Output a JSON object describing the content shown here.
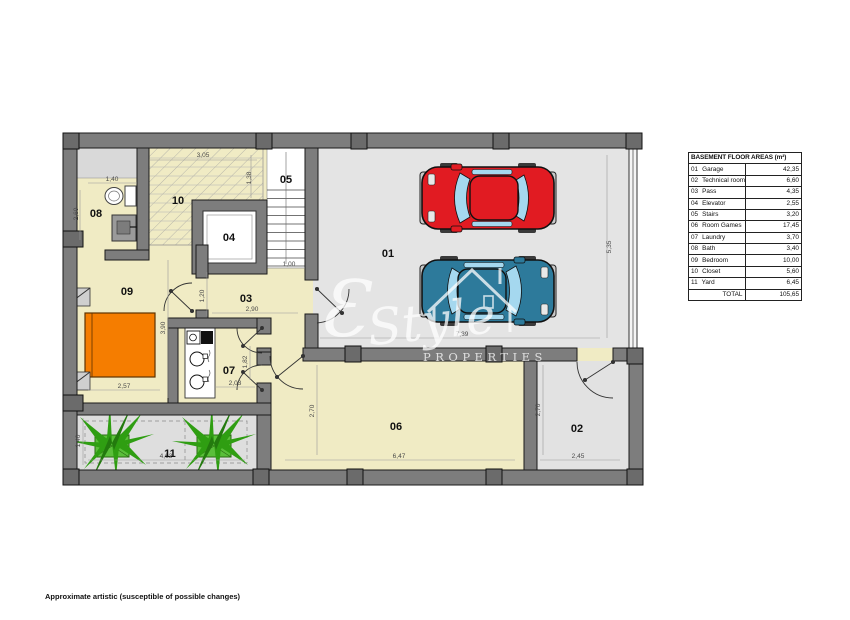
{
  "legend": {
    "title": "BASEMENT FLOOR AREAS (m²)",
    "rows": [
      {
        "no": "01",
        "name": "Garage",
        "area": "42,35"
      },
      {
        "no": "02",
        "name": "Technical room",
        "area": "6,60"
      },
      {
        "no": "03",
        "name": "Pass",
        "area": "4,35"
      },
      {
        "no": "04",
        "name": "Elevator",
        "area": "2,55"
      },
      {
        "no": "05",
        "name": "Stairs",
        "area": "3,20"
      },
      {
        "no": "06",
        "name": "Room Games",
        "area": "17,45"
      },
      {
        "no": "07",
        "name": "Laundry",
        "area": "3,70"
      },
      {
        "no": "08",
        "name": "Bath",
        "area": "3,40"
      },
      {
        "no": "09",
        "name": "Bedroom",
        "area": "10,00"
      },
      {
        "no": "10",
        "name": "Closet",
        "area": "5,60"
      },
      {
        "no": "11",
        "name": "Yard",
        "area": "6,45"
      }
    ],
    "total_label": "TOTAL",
    "total_value": "105,65"
  },
  "plan": {
    "room_labels": {
      "r01": "01",
      "r02": "02",
      "r03": "03",
      "r04": "04",
      "r05": "05",
      "r06": "06",
      "r07": "07",
      "r08": "08",
      "r09": "09",
      "r10": "10",
      "r11": "11"
    },
    "dims": {
      "closet_w": "3,05",
      "closet_h": "1,38",
      "bath_w": "1,40",
      "bath_h": "2,60",
      "stairs_w": "1,00",
      "garage_h": "5,35",
      "garage_w": "7,89",
      "bed_h": "3,90",
      "pass_d": "1,20",
      "pass_w": "2,90",
      "bed_w": "2,57",
      "laundry_w": "2,03",
      "laundry_h": "1,82",
      "yard_h": "1,40",
      "yard_w": "4,63",
      "games_h": "2,70",
      "games_w": "6,47",
      "tech_h": "2,70",
      "tech_w": "2,45"
    },
    "watermark": {
      "initial": "Ɛ",
      "script": "Style",
      "caption": "PROPERTIES"
    }
  },
  "footer": {
    "disclaimer": "Approximate artistic (susceptible of possible changes)"
  },
  "colors": {
    "cream": "#f0ebc4",
    "garage_floor": "#e4e4e4",
    "yard_floor": "#dedede",
    "wall": "#7d7d7d",
    "pillar": "#6b6b6b",
    "red_car": "#e11b22",
    "blue_car": "#2d7a9b",
    "car_window": "#a5d8ef",
    "bed_orange": "#f57d00",
    "plant_green": "#2f9e12"
  }
}
